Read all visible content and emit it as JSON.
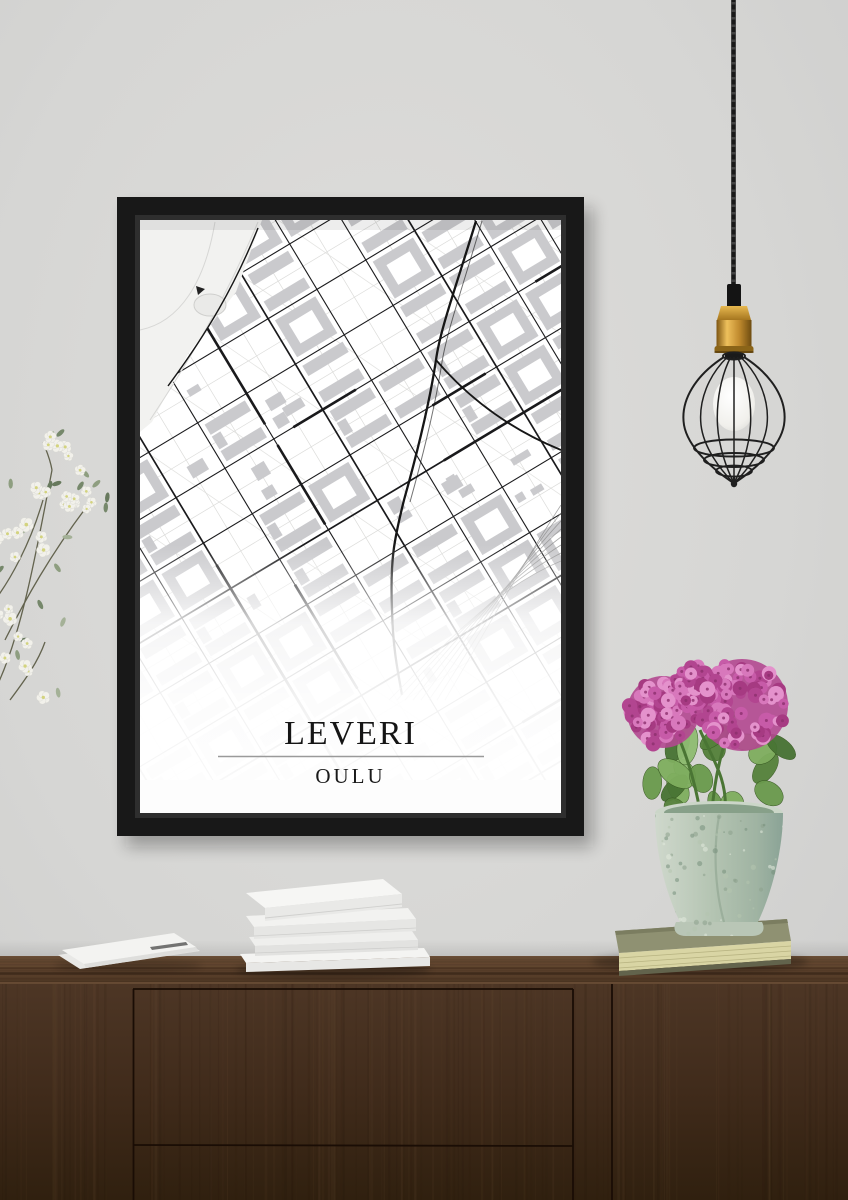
{
  "poster": {
    "title": "LEVERI",
    "subtitle": "OULU"
  },
  "scene": {
    "wall_color": "#d7d7d5",
    "frame_color": "#181818",
    "poster_color": "#fdfdfd",
    "map": {
      "road_color": "#1a1a1c",
      "minor_road_color": "#dcdcda",
      "building_color": "#cacacd",
      "park_color": "#f2f2f0",
      "shore_color": "#8a8a8a"
    },
    "sideboard": {
      "wood_mid": "#44301f",
      "wood_dark": "#1c0f06",
      "wood_light": "#7a5a3e",
      "seam_color": "#1a0d05"
    },
    "lamp": {
      "cord_color": "#191919",
      "brass_color": "#c08a2e",
      "cage_color": "#1f1f1f",
      "bulb_color": "#f7f6f2"
    },
    "flowers_left": {
      "petal_color": "#f2f1eb",
      "petal_edge": "#d5d5cf",
      "center_color": "#d3d37e",
      "leaf_colors": [
        "#8e9e80",
        "#76886b",
        "#a4b197",
        "#67795d"
      ],
      "branch_color": "#63634e"
    },
    "plant_right": {
      "flower_colors": [
        "#d878bc",
        "#c75ba8",
        "#b24590",
        "#e492cc",
        "#a63a82"
      ],
      "flower_base": "#b24890",
      "flower_center": "#8c2f6d",
      "leaf_colors": [
        "#55813b",
        "#6a9a4d",
        "#7fae5f",
        "#477333",
        "#8fbc72"
      ],
      "stem_color": "#4a7534",
      "pot_colors": [
        "#cfd8cc",
        "#aebfb0",
        "#8aa396"
      ],
      "pot_speckles": [
        "#8ca18c",
        "#e2eadd",
        "#768f7c",
        "#b4c4ae"
      ],
      "book_cover": "#8f9172",
      "book_pages": "#d9d5a4",
      "book_bottom": "#62634c"
    },
    "books": {
      "paper_white": "#f3f3f1",
      "paper_shade": "#e2e2e0"
    }
  }
}
